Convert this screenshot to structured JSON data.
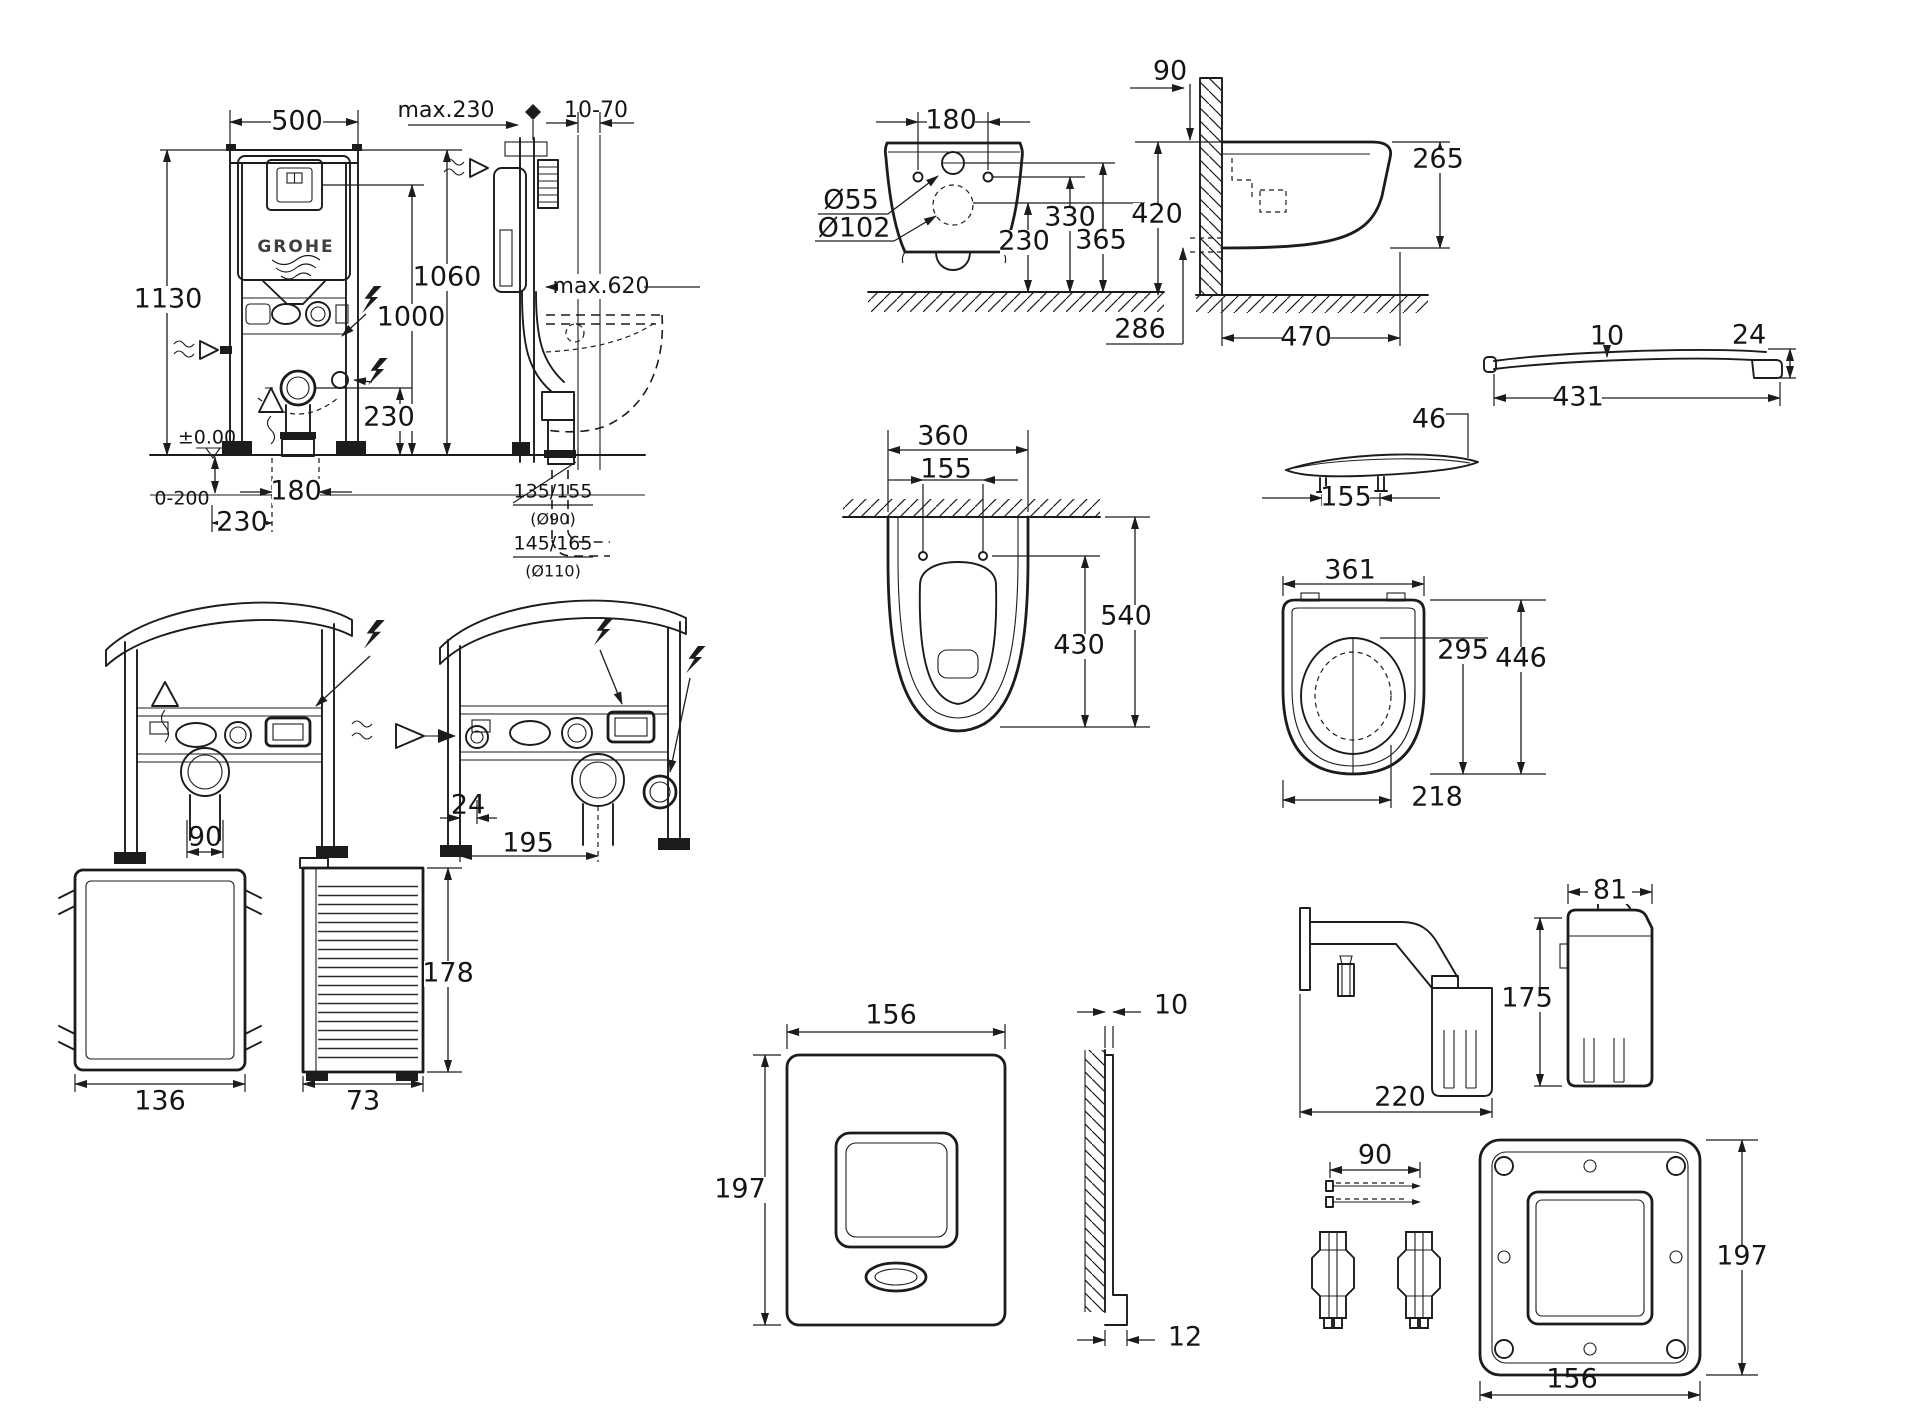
{
  "brand_logo": "GROHE",
  "frame_front": {
    "width": "500",
    "height": "1130",
    "height_flush": "1060",
    "height_supply": "1000",
    "drain_height": "230",
    "zero_level": "±0.00",
    "floor_range": "0-200",
    "drain_offset": "180",
    "drain_offset2": "230"
  },
  "frame_side": {
    "depth_max": "max.230",
    "wall_thickness": "10-70",
    "seat_reach": "max.620",
    "outlet_h_90": "135/155",
    "outlet_d_90": "(Ø90)",
    "outlet_h_110": "145/165",
    "outlet_d_110": "(Ø110)"
  },
  "wc_front": {
    "hole_spacing": "180",
    "inlet_dia": "Ø55",
    "outlet_dia": "Ø102",
    "inlet_height": "330",
    "top_height": "365",
    "outlet_height": "230",
    "outlet_depth": "286"
  },
  "wc_side": {
    "inset": "90",
    "rim_height": "420",
    "body_height": "265",
    "depth": "470"
  },
  "wc_top": {
    "width": "360",
    "hole_spacing": "155",
    "depth": "540",
    "hole_to_front": "430"
  },
  "seat_section": {
    "thickness": "46",
    "hinge_spacing": "155"
  },
  "seat_profile": {
    "front_thickness": "10",
    "rear_thickness": "24",
    "length": "431"
  },
  "seat_top": {
    "width": "361",
    "inner_length": "295",
    "length": "446",
    "hinge_offset": "218"
  },
  "frames_34": {
    "drain_offset_left": "90",
    "rail_gap": "24",
    "drain_offset_right": "195"
  },
  "protection_box": {
    "width": "136",
    "height": "178",
    "depth": "73"
  },
  "flush_plate": {
    "width": "156",
    "height": "197",
    "thickness": "10",
    "frame_depth": "12"
  },
  "wall_bracket": {
    "length": "220"
  },
  "cartridge": {
    "width": "81",
    "height": "175"
  },
  "mounting_frame": {
    "screw_length": "90",
    "width": "156",
    "height": "197"
  }
}
